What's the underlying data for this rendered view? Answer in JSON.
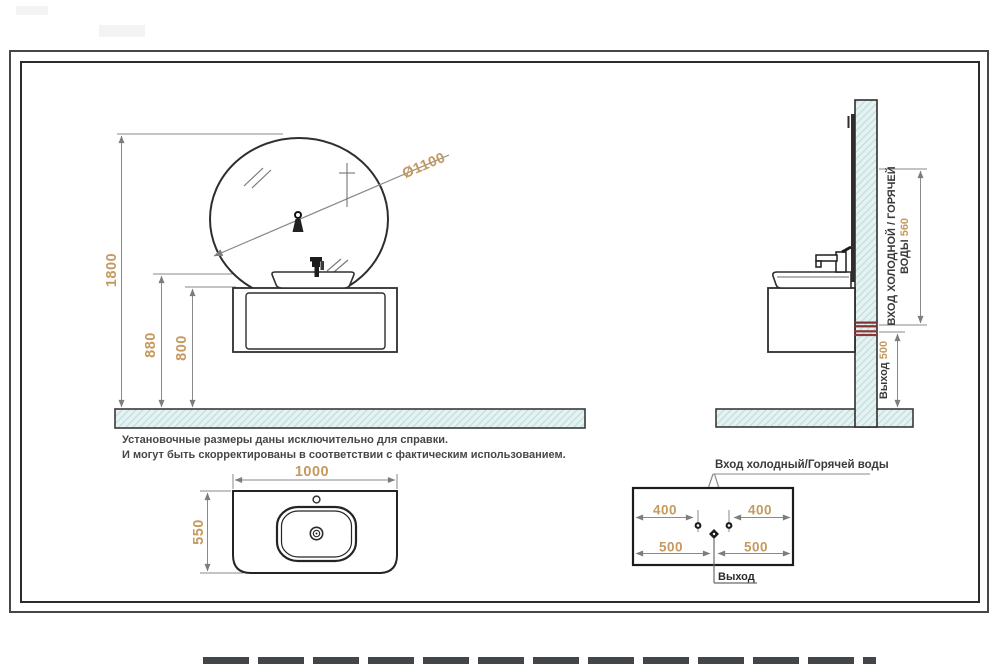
{
  "drawing": {
    "notes": {
      "line1": "Установочные размеры даны исключительно для справки.",
      "line2": "И могут быть скорректированы в соответствии с фактическим использованием."
    },
    "front_view": {
      "total_height": "1800",
      "rim_height": "880",
      "cabinet_top_height": "800",
      "mirror_diameter": "Ø1100"
    },
    "side_view": {
      "inlet_line1": "ВХОД ХОЛОДНОЙ / ГОРЯЧЕЙ",
      "inlet_line2": "ВОДЫ",
      "inlet_height": "560",
      "outlet_label": "Выход",
      "outlet_height": "500"
    },
    "top_view": {
      "width": "1000",
      "depth": "550"
    },
    "schematic": {
      "title": "Вход холодный/Горячей воды",
      "inlet_offset_left": "400",
      "inlet_offset_right": "400",
      "outlet_offset_left": "500",
      "outlet_offset_right": "500",
      "outlet_label": "Выход"
    },
    "colors": {
      "dimension_text": "#c49a5f",
      "hatch_fill": "#e4f2f1",
      "hatch_line": "#bcdcdc",
      "line_dark": "#2e2e2e",
      "dim_line": "#8a8a8a",
      "pipe_red": "#7d3333"
    }
  }
}
